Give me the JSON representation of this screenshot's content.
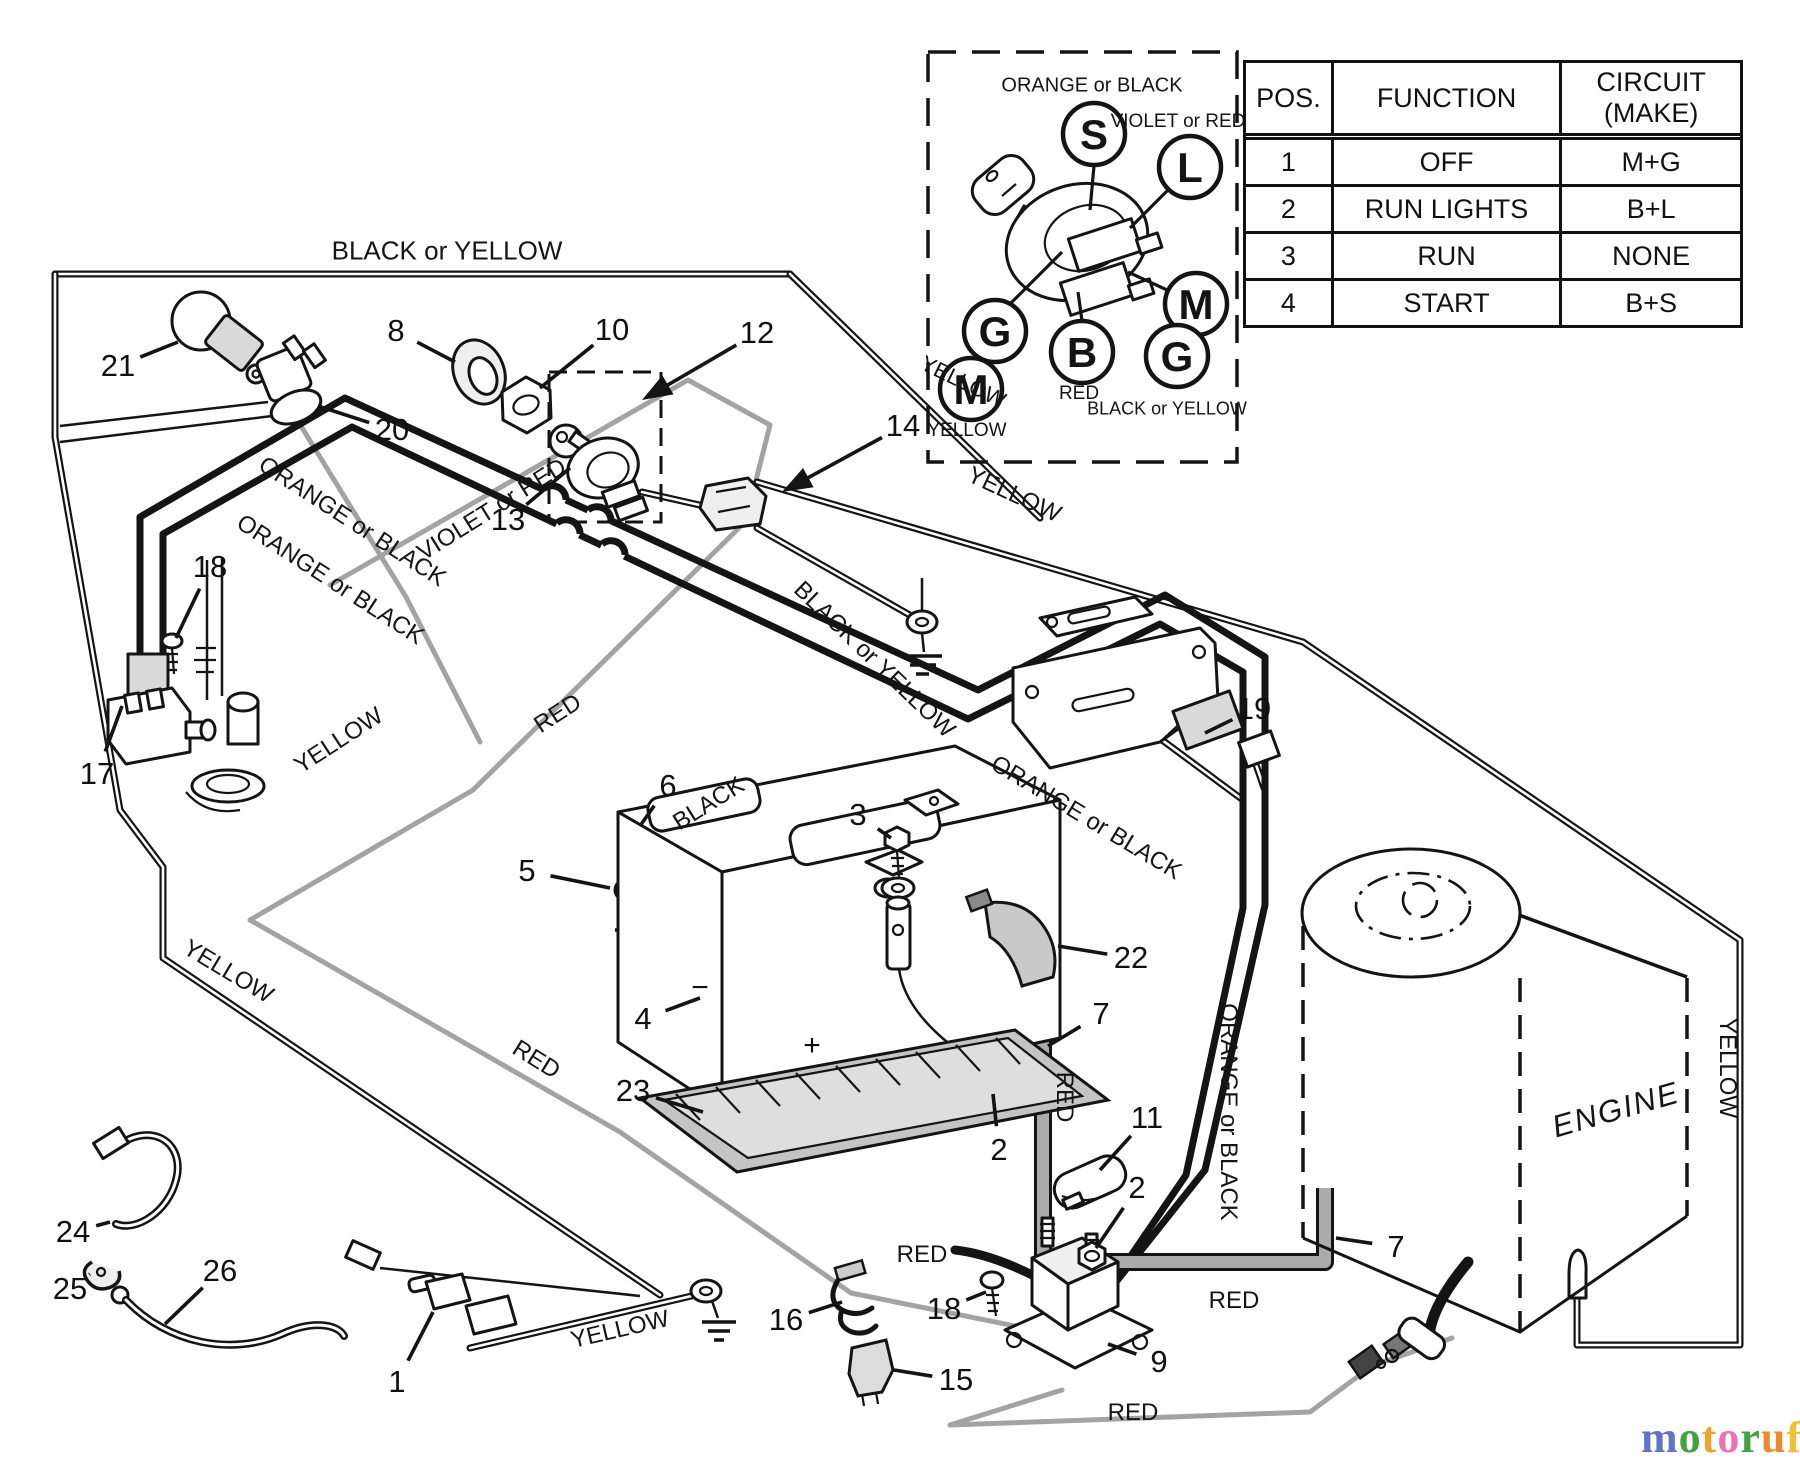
{
  "colors": {
    "line": "#141414",
    "gray_wire": "#a3a3a3",
    "component_gray": "#d9d9d9",
    "logo_suffix_gray": "#8f8f8f"
  },
  "table": {
    "headers": [
      "POS.",
      "FUNCTION",
      "CIRCUIT  (MAKE)"
    ],
    "rows": [
      [
        "1",
        "OFF",
        "M+G"
      ],
      [
        "2",
        "RUN LIGHTS",
        "B+L"
      ],
      [
        "3",
        "RUN",
        "NONE"
      ],
      [
        "4",
        "START",
        "B+S"
      ]
    ]
  },
  "inset": {
    "top_label": "ORANGE or BLACK",
    "terminals": [
      {
        "letter": "S",
        "x": 1094,
        "y": 134
      },
      {
        "letter": "L",
        "x": 1190,
        "y": 167
      },
      {
        "letter": "M",
        "x": 1196,
        "y": 304
      },
      {
        "letter": "G",
        "x": 995,
        "y": 331
      },
      {
        "letter": "B",
        "x": 1082,
        "y": 352
      },
      {
        "letter": "G",
        "x": 1177,
        "y": 356
      },
      {
        "letter": "M",
        "x": 971,
        "y": 389
      }
    ],
    "labels": [
      {
        "text": "VIOLET or RED",
        "x": 1178,
        "y": 122,
        "size": 19
      },
      {
        "text": "RED",
        "x": 1079,
        "y": 394,
        "size": 19
      },
      {
        "text": "BLACK or YELLOW",
        "x": 1167,
        "y": 409,
        "size": 18
      },
      {
        "text": "YELLOW",
        "x": 967,
        "y": 431,
        "size": 19
      }
    ],
    "lines": [
      [
        1094,
        166,
        1090,
        210
      ],
      [
        1170,
        188,
        1130,
        228
      ],
      [
        1008,
        306,
        1062,
        252
      ],
      [
        1082,
        321,
        1078,
        292
      ],
      [
        1167,
        290,
        1128,
        272
      ]
    ]
  },
  "wire_labels": [
    {
      "text": "BLACK or YELLOW",
      "x": 447,
      "y": 251,
      "rot": 0,
      "size": 26
    },
    {
      "text": "ORANGE or BLACK",
      "x": 352,
      "y": 522,
      "rot": 33,
      "size": 24
    },
    {
      "text": "ORANGE or BLACK",
      "x": 330,
      "y": 580,
      "rot": 33,
      "size": 24
    },
    {
      "text": "VIOLET or RED",
      "x": 492,
      "y": 510,
      "rot": -32,
      "size": 24
    },
    {
      "text": "YELLOW",
      "x": 339,
      "y": 741,
      "rot": -33,
      "size": 24
    },
    {
      "text": "RED",
      "x": 558,
      "y": 714,
      "rot": -33,
      "size": 24
    },
    {
      "text": "BLACK",
      "x": 709,
      "y": 804,
      "rot": -32,
      "size": 24
    },
    {
      "text": "YELLOW",
      "x": 963,
      "y": 382,
      "rot": 26,
      "size": 22
    },
    {
      "text": "YELLOW",
      "x": 1014,
      "y": 495,
      "rot": 25,
      "size": 24
    },
    {
      "text": "BLACK or YELLOW",
      "x": 874,
      "y": 660,
      "rot": 44,
      "size": 24
    },
    {
      "text": "ORANGE or BLACK",
      "x": 1086,
      "y": 818,
      "rot": 31,
      "size": 24
    },
    {
      "text": "YELLOW",
      "x": 228,
      "y": 972,
      "rot": 31,
      "size": 24
    },
    {
      "text": "RED",
      "x": 536,
      "y": 1060,
      "rot": 32,
      "size": 24
    },
    {
      "text": "RED",
      "x": 922,
      "y": 1255,
      "rot": 0,
      "size": 24
    },
    {
      "text": "RED",
      "x": 1064,
      "y": 1097,
      "rot": 90,
      "size": 24
    },
    {
      "text": "ORANGE or BLACK",
      "x": 1228,
      "y": 1112,
      "rot": 90,
      "size": 24
    },
    {
      "text": "RED",
      "x": 1234,
      "y": 1301,
      "rot": 0,
      "size": 24
    },
    {
      "text": "RED",
      "x": 1133,
      "y": 1413,
      "rot": 0,
      "size": 24
    },
    {
      "text": "YELLOW",
      "x": 1727,
      "y": 1068,
      "rot": 90,
      "size": 24
    },
    {
      "text": "YELLOW",
      "x": 620,
      "y": 1330,
      "rot": -13,
      "size": 24
    },
    {
      "text": "ENGINE",
      "x": 1616,
      "y": 1110,
      "rot": -16,
      "size": 31,
      "italic": true
    }
  ],
  "callouts": [
    {
      "n": "21",
      "x": 118,
      "y": 366,
      "tx": 178,
      "ty": 342
    },
    {
      "n": "20",
      "x": 392,
      "y": 430,
      "tx": 318,
      "ty": 406
    },
    {
      "n": "8",
      "x": 396,
      "y": 331,
      "tx": 455,
      "ty": 362
    },
    {
      "n": "10",
      "x": 612,
      "y": 330,
      "tx": 540,
      "ty": 388
    },
    {
      "n": "12",
      "x": 757,
      "y": 333,
      "tx": 642,
      "ty": 400,
      "arrow": true
    },
    {
      "n": "13",
      "x": 508,
      "y": 520,
      "tx": 570,
      "ty": 468
    },
    {
      "n": "14",
      "x": 903,
      "y": 426,
      "tx": 782,
      "ty": 492,
      "arrow": true
    },
    {
      "n": "18",
      "x": 210,
      "y": 567,
      "tx": 176,
      "ty": 638
    },
    {
      "n": "17",
      "x": 97,
      "y": 774,
      "tx": 122,
      "ty": 706
    },
    {
      "n": "6",
      "x": 668,
      "y": 786,
      "tx": 640,
      "ty": 826
    },
    {
      "n": "5",
      "x": 527,
      "y": 871,
      "tx": 610,
      "ty": 888
    },
    {
      "n": "3",
      "x": 858,
      "y": 815,
      "tx": 891,
      "ty": 838
    },
    {
      "n": "4",
      "x": 643,
      "y": 1019,
      "tx": 700,
      "ty": 998
    },
    {
      "n": "23",
      "x": 633,
      "y": 1091,
      "tx": 703,
      "ty": 1112
    },
    {
      "n": "22",
      "x": 1131,
      "y": 958,
      "tx": 1058,
      "ty": 946
    },
    {
      "n": "7",
      "x": 1101,
      "y": 1014,
      "tx": 1048,
      "ty": 1046
    },
    {
      "n": "11",
      "x": 1147,
      "y": 1118,
      "tx": 1100,
      "ty": 1170
    },
    {
      "n": "2",
      "x": 999,
      "y": 1150,
      "tx": 993,
      "ty": 1094
    },
    {
      "n": "2",
      "x": 1137,
      "y": 1188,
      "tx": 1096,
      "ty": 1248
    },
    {
      "n": "19",
      "x": 1254,
      "y": 709,
      "tx": 1205,
      "ty": 733
    },
    {
      "n": "24",
      "x": 73,
      "y": 1232,
      "tx": 110,
      "ty": 1222
    },
    {
      "n": "25",
      "x": 70,
      "y": 1289,
      "tx": 90,
      "ty": 1274
    },
    {
      "n": "26",
      "x": 220,
      "y": 1271,
      "tx": 165,
      "ty": 1324
    },
    {
      "n": "1",
      "x": 397,
      "y": 1382,
      "tx": 433,
      "ty": 1312
    },
    {
      "n": "16",
      "x": 786,
      "y": 1320,
      "tx": 842,
      "ty": 1302
    },
    {
      "n": "18",
      "x": 944,
      "y": 1309,
      "tx": 986,
      "ty": 1292
    },
    {
      "n": "15",
      "x": 956,
      "y": 1380,
      "tx": 894,
      "ty": 1370
    },
    {
      "n": "9",
      "x": 1159,
      "y": 1362,
      "tx": 1108,
      "ty": 1344
    },
    {
      "n": "7",
      "x": 1396,
      "y": 1247,
      "tx": 1336,
      "ty": 1238
    }
  ],
  "battery": {
    "plus": "+",
    "minus": "−"
  },
  "logo": {
    "letters": [
      {
        "ch": "m",
        "color": "#6272c7"
      },
      {
        "ch": "o",
        "color": "#3ea53e"
      },
      {
        "ch": "t",
        "color": "#eda32d"
      },
      {
        "ch": "o",
        "color": "#f070b2"
      },
      {
        "ch": "r",
        "color": "#3ea53e"
      },
      {
        "ch": "u",
        "color": "#ef8a2c"
      },
      {
        "ch": "f",
        "color": "#edc32d"
      }
    ],
    "suffix": ".de"
  }
}
